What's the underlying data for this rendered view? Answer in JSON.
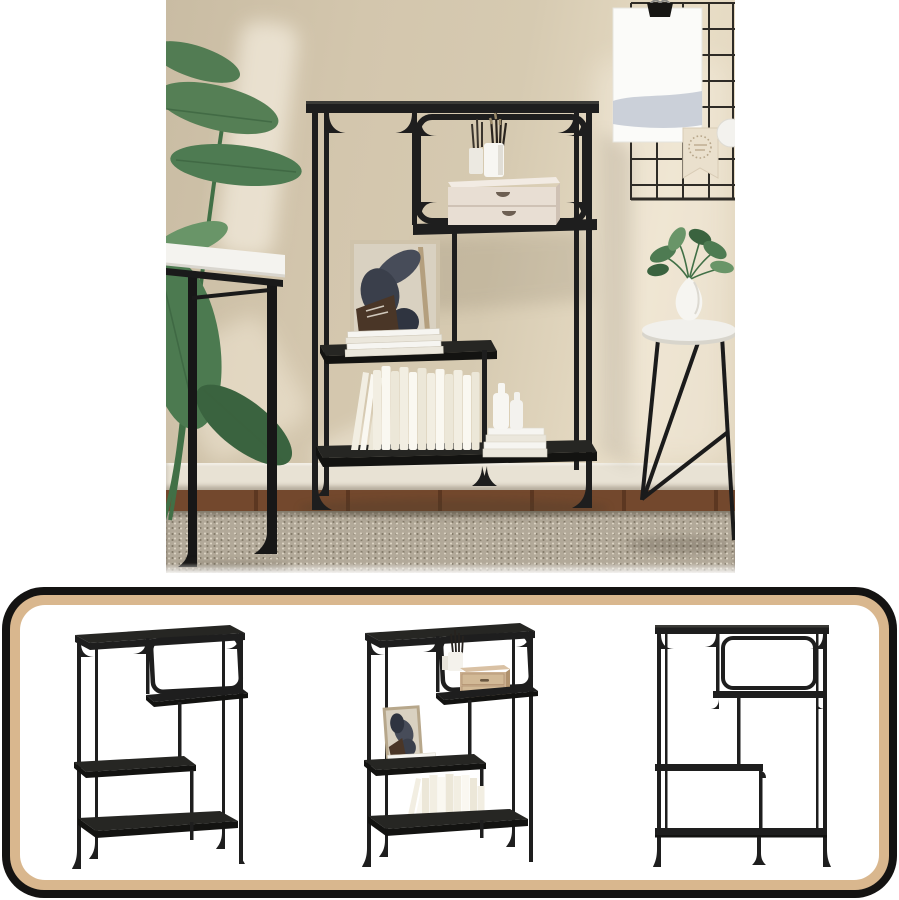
{
  "image_alt": "Black industrial console table with shelves: styled room photo above a bordered strip of three catalog views",
  "colors": {
    "page_bg": "#ffffff",
    "wall_dark": "#c9bca3",
    "wall_mid": "#d6cab1",
    "wall_light": "#e8ddc6",
    "baseboard": "#e8e2d4",
    "floor_wood": "#73482d",
    "floor_wood_dark": "#5c3721",
    "rug_base": "#b2a999",
    "rug_speck_light": "#dbd3c3",
    "rug_speck_dark": "#857c6b",
    "metal_black": "#1e1e1e",
    "metal_soft": "#262623",
    "metal_dark": "#131311",
    "metal_edge": "#4e4e47",
    "desk_white": "#f4f3ef",
    "desk_edge": "#d9d6cf",
    "plant_green": "#4e7b52",
    "plant_dark": "#3a633f",
    "plant_light": "#699568",
    "plant_stem": "#417046",
    "grid_line": "#2e2b26",
    "poster_white": "#fbfbf9",
    "poster_band": "#c5cbd5",
    "clip_black": "#171614",
    "pennant_cream": "#eae0cd",
    "pennant_dots": "#b7a68a",
    "ball_white": "#f3f2ee",
    "table_white": "#f1f0ec",
    "table_rim": "#d8d5cc",
    "vase_white": "#f6f5f1",
    "hero_box_face": "#e8ded3",
    "hero_box_top": "#f2ebe3",
    "hero_box_side": "#cfc1b4",
    "hero_box_slot": "#6d5f52",
    "hero_box_line": "#cfc2b5",
    "drawer_wood": "#cbb091",
    "drawer_wood_dark": "#b0926e",
    "drawer_face": "#d2b996",
    "drawer_slot": "#6a5740",
    "art_bg": "#d9d1c1",
    "art_frame_wood": "#cfc3ab",
    "art_ink": "#474c59",
    "art_ink2": "#3a3f4b",
    "art_ink3": "#2f3440",
    "art_brown": "#4a3627",
    "art_stick": "#b49f7e",
    "book_cream": "#f2eee2",
    "book_white": "#faf8f1",
    "book_mid": "#ece7d8",
    "magazine_light": "#f6f5f1",
    "magazine_dark": "#ebe7dc",
    "bottle_white": "#f7f6f2",
    "shadow_warm": "#6b5f49",
    "panel_border": "#141312",
    "panel_tan": "#d9b78e",
    "panel_bg": "#ffffff"
  },
  "hero": {
    "labels": {
      "scene": "Styled room scene with black metal console table",
      "console_table": "Black metal console table with asymmetric shelves",
      "banana_plant": "Potted banana plant",
      "desk": "White desk with black metal legs",
      "wire_grid": "Black wire memo grid on wall",
      "poster": "Blank white poster hung with binder clip",
      "pennant": "Cream pennant flag with dotted badge",
      "bauble": "White round wall ornament",
      "side_table": "Round white side table with black hairpin legs",
      "vase_plant": "White teardrop vase with green sprigs",
      "brush_cup": "White cups holding paintbrushes and pencils",
      "drawer_box": "Whitewashed two-drawer mini chest",
      "art_frame": "Leaning art print with abstract dark shapes",
      "magazines": "Stack of white magazines",
      "books": "Row of cream books on bottom shelf",
      "bottles": "White bottles on stacked white books",
      "rug": "Beige woven area rug",
      "wood_floor": "Dark brown wood floor",
      "baseboard": "White baseboard"
    }
  },
  "panel": {
    "labels": {
      "strip": "Catalog strip with three product views of the console table",
      "view_angled_empty": "Console table, angled view, empty",
      "view_angled_styled": "Console table, angled view with decor",
      "view_front": "Console table, front view, empty"
    }
  }
}
